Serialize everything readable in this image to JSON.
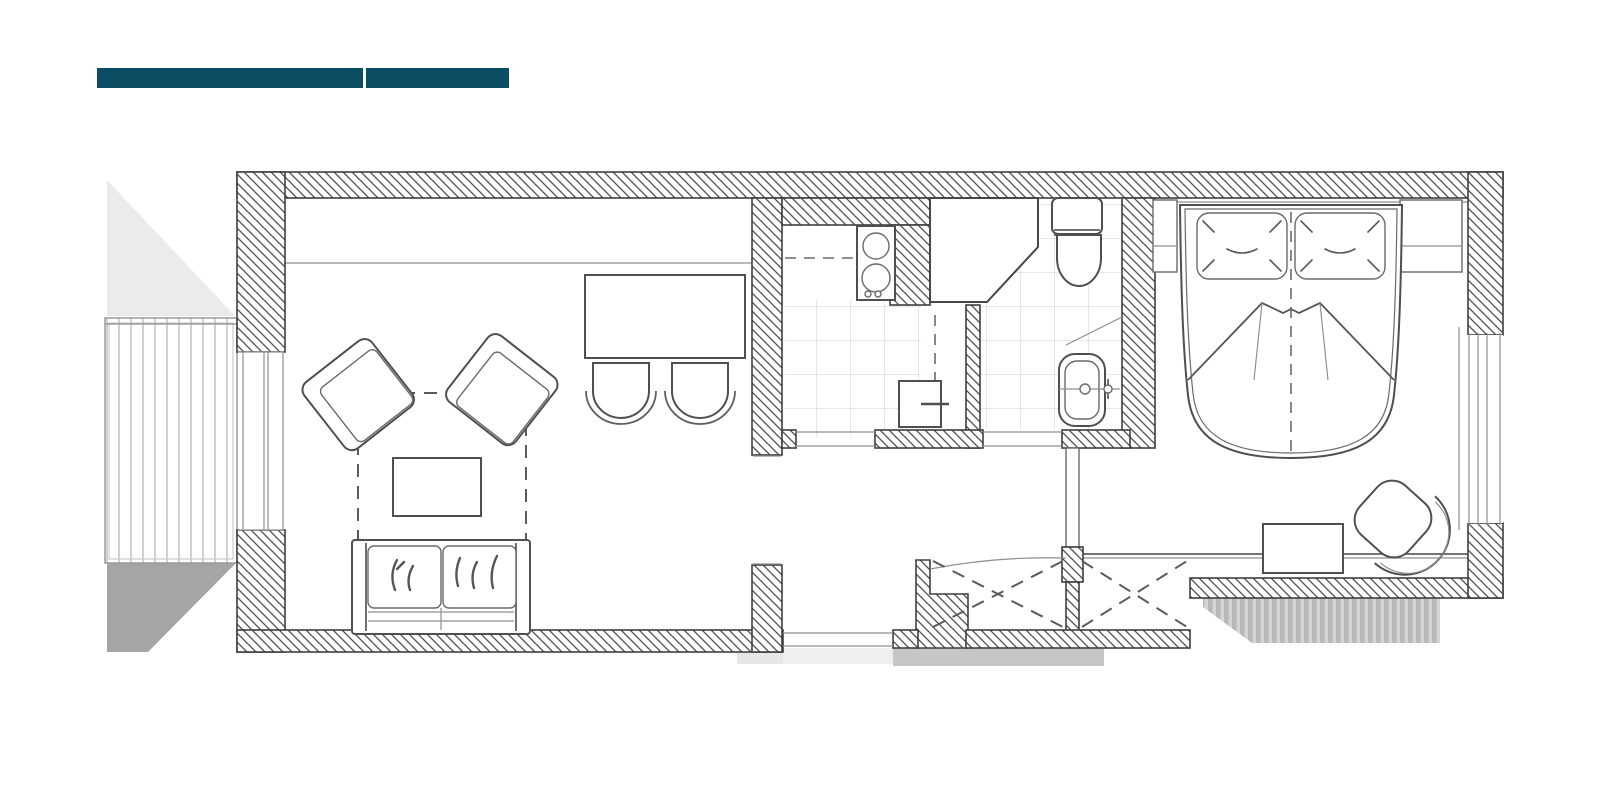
{
  "title_bars": {
    "primary": {
      "color": "#0b4e63"
    },
    "secondary": {
      "color": "#0b4e63"
    }
  },
  "floor_plan": {
    "background": "#ffffff",
    "wall_outline": "#3f3f3f",
    "hatch_line": "#4d4d4d",
    "furniture_line": "#4f4f4f",
    "tile_line": "#cfcfcf",
    "dashed_line": "#5a5a5a",
    "shadow_light": "#ebebeb",
    "shadow_dark": "#a5a5a5",
    "shadow_band": "#c6c6c6",
    "shadow_under_entry": "#efefef",
    "shadow_under_step": "#e6e6e6",
    "deck_plank_line": "#b4b4b4"
  }
}
